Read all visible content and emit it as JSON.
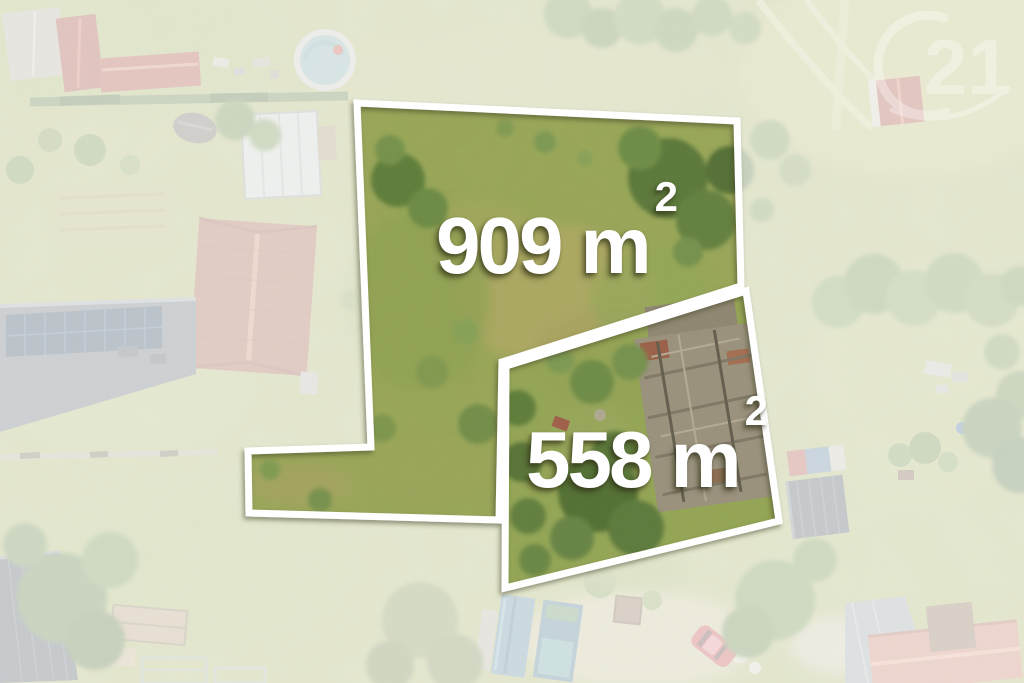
{
  "plots": [
    {
      "name": "plot-909",
      "area_value": "909",
      "area_unit": "m",
      "area_exponent": "2"
    },
    {
      "name": "plot-558",
      "area_value": "558",
      "area_unit": "m",
      "area_exponent": "2"
    }
  ],
  "watermark": {
    "text": "21"
  },
  "colors": {
    "plot_outline": "#ffffff",
    "area_label_text": "#ffffff",
    "fade_overlay": "#ffffff"
  }
}
